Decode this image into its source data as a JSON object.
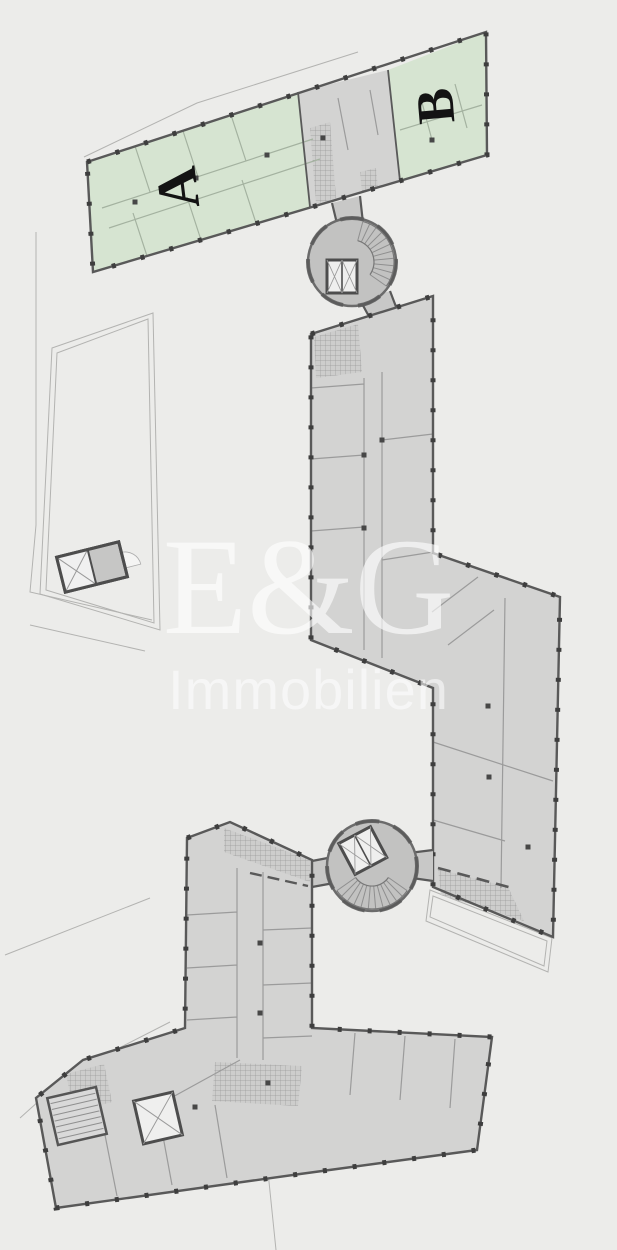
{
  "plan": {
    "watermark": {
      "title": "E&G",
      "subtitle": "Immobilien"
    },
    "building_labels": [
      {
        "id": "section-a",
        "text": "A"
      },
      {
        "id": "section-b",
        "text": "B"
      }
    ],
    "colors": {
      "background": "#ececea",
      "highlight_green": "#d6e4d1",
      "partition_green": "#a4b2a0",
      "building_gray": "#d3d3d2",
      "core_gray": "#c2c2c1",
      "corridor_gray": "#c8c8c7",
      "wall_dark": "#595959",
      "tick_dark": "#3e3e3e",
      "partition_gray": "#9b9b9b",
      "outline_thin": "#b3b3b1",
      "tile_base": "#cdcdcc",
      "tile_line": "#9a9a9a",
      "stair_line": "#8f8f8f",
      "pillar_dark": "#474747",
      "elev_fill": "#efefee",
      "label_dark": "#131313"
    }
  }
}
